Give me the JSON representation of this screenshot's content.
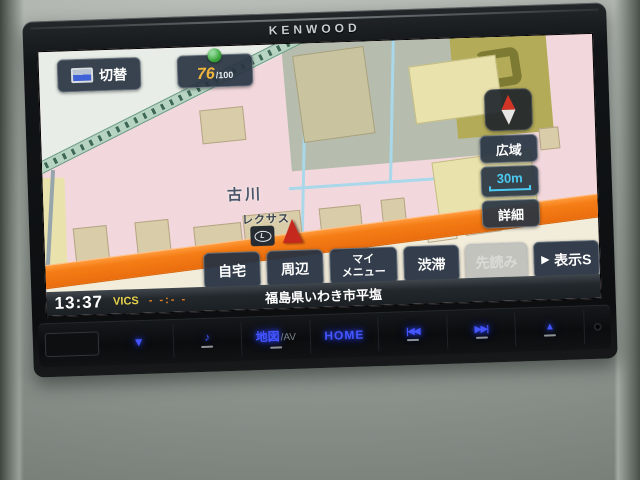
{
  "brand": "KENWOOD",
  "screen": {
    "topbar": {
      "switch": "切替",
      "gps_value": "76",
      "gps_max": "/100"
    },
    "right": {
      "wide": "広域",
      "scale": "30m",
      "detail": "詳細"
    },
    "map": {
      "area_label": "古川",
      "poi_label": "レクサス",
      "poi_logo": "L"
    },
    "menu": {
      "home": "自宅",
      "nearby": "周辺",
      "my1": "マイ",
      "my2": "メニュー",
      "traffic": "渋滞",
      "lookahead": "先読み",
      "display_arrow": "▶",
      "display": "表示S"
    },
    "status": {
      "time": "13:37",
      "vics": "VICS",
      "eta": "- -:- -",
      "address": "福島県いわき市平塩"
    }
  },
  "hardware": {
    "vol_down": "▼",
    "audio": "♪",
    "map_av": "地図",
    "map_av_suffix": "/AV",
    "home": "HOME",
    "prev": "|◀◀",
    "next": "▶▶|",
    "eject": "▲"
  },
  "colors": {
    "road_orange": "#f57d16",
    "scale_cyan": "#4cc9f0",
    "gps_green": "#3aa53a",
    "vics_yellow": "#e6d14a",
    "cursor_red": "#c5281c",
    "button_navy": "#263242"
  }
}
